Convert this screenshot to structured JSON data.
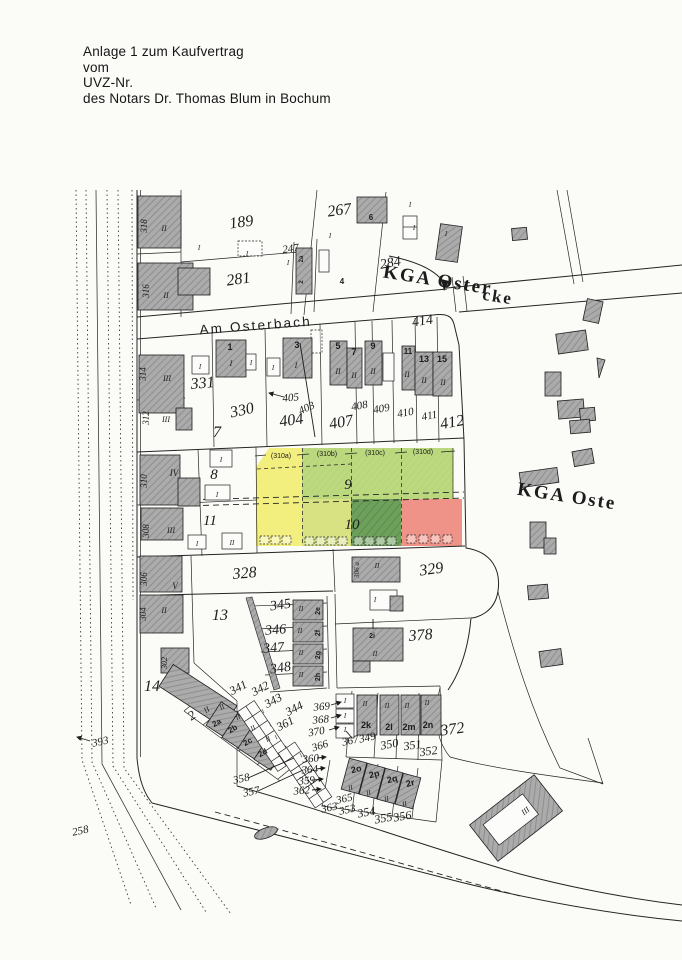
{
  "header": {
    "line1": "Anlage 1 zum Kaufvertrag",
    "line2": "vom",
    "line3": "UVZ-Nr.",
    "line4": "des Notars Dr. Thomas Blum in Bochum"
  },
  "map": {
    "street_label": "Am Osterbach",
    "kga_top_label": "KGA Oster",
    "kga_top_label_cont": "cke",
    "kga_right_label": "KGA Oste",
    "highlight_colors": {
      "yellow": "#f1ee69",
      "light_green": "#b2d46a",
      "yellow_green": "#d3de6e",
      "dark_green": "#55913f",
      "red": "#ee8175"
    },
    "labels": [
      {
        "t": "318",
        "x": 147,
        "y": 226,
        "r": -90,
        "s": 9,
        "c": "vert"
      },
      {
        "t": "II",
        "x": 164,
        "y": 231,
        "s": 8,
        "c": "roman"
      },
      {
        "t": "316",
        "x": 149,
        "y": 291,
        "r": -90,
        "s": 9,
        "c": "vert"
      },
      {
        "t": "II",
        "x": 166,
        "y": 298,
        "s": 8,
        "c": "roman"
      },
      {
        "t": "189",
        "x": 242,
        "y": 227,
        "r": -8,
        "s": 16
      },
      {
        "t": "267",
        "x": 340,
        "y": 215,
        "r": -8,
        "s": 16
      },
      {
        "t": "247",
        "x": 291,
        "y": 252,
        "r": -8,
        "s": 11
      },
      {
        "t": "281",
        "x": 239,
        "y": 284,
        "r": -8,
        "s": 16
      },
      {
        "t": "284",
        "x": 391,
        "y": 267,
        "r": -10,
        "s": 14
      },
      {
        "t": "414",
        "x": 423,
        "y": 325,
        "r": -8,
        "s": 14
      },
      {
        "t": "6",
        "x": 371,
        "y": 220,
        "s": 8,
        "c": "house"
      },
      {
        "t": "4",
        "x": 342,
        "y": 284,
        "s": 8,
        "c": "house"
      },
      {
        "t": "2a",
        "x": 303,
        "y": 259,
        "r": -90,
        "s": 6,
        "c": "house"
      },
      {
        "t": "2",
        "x": 303,
        "y": 282,
        "r": -90,
        "s": 6,
        "c": "house"
      },
      {
        "t": "I",
        "x": 199,
        "y": 250,
        "s": 7,
        "c": "roman"
      },
      {
        "t": "I",
        "x": 247,
        "y": 256,
        "s": 7,
        "c": "roman"
      },
      {
        "t": "I",
        "x": 288,
        "y": 265,
        "s": 7,
        "c": "roman"
      },
      {
        "t": "I",
        "x": 330,
        "y": 238,
        "s": 7,
        "c": "roman"
      },
      {
        "t": "I",
        "x": 410,
        "y": 207,
        "s": 7,
        "c": "roman"
      },
      {
        "t": "I",
        "x": 414,
        "y": 230,
        "s": 7,
        "c": "roman"
      },
      {
        "t": "I",
        "x": 446,
        "y": 236,
        "s": 7,
        "c": "roman"
      },
      {
        "t": "1",
        "x": 230,
        "y": 350,
        "s": 9,
        "c": "house"
      },
      {
        "t": "3",
        "x": 297,
        "y": 348,
        "s": 9,
        "c": "house"
      },
      {
        "t": "5",
        "x": 338,
        "y": 349,
        "s": 9,
        "c": "house"
      },
      {
        "t": "7",
        "x": 354,
        "y": 355,
        "s": 9,
        "c": "house"
      },
      {
        "t": "9",
        "x": 373,
        "y": 349,
        "s": 9,
        "c": "house"
      },
      {
        "t": "11",
        "x": 408,
        "y": 354,
        "s": 8,
        "c": "house"
      },
      {
        "t": "13",
        "x": 424,
        "y": 362,
        "s": 9,
        "c": "house"
      },
      {
        "t": "15",
        "x": 442,
        "y": 362,
        "s": 9,
        "c": "house"
      },
      {
        "t": "I",
        "x": 231,
        "y": 366,
        "s": 8,
        "c": "roman"
      },
      {
        "t": "I",
        "x": 296,
        "y": 368,
        "s": 8,
        "c": "roman"
      },
      {
        "t": "II",
        "x": 338,
        "y": 374,
        "s": 8,
        "c": "roman"
      },
      {
        "t": "II",
        "x": 354,
        "y": 378,
        "s": 8,
        "c": "roman"
      },
      {
        "t": "II",
        "x": 373,
        "y": 374,
        "s": 8,
        "c": "roman"
      },
      {
        "t": "II",
        "x": 407,
        "y": 377,
        "s": 8,
        "c": "roman"
      },
      {
        "t": "II",
        "x": 424,
        "y": 383,
        "s": 8,
        "c": "roman"
      },
      {
        "t": "II",
        "x": 443,
        "y": 385,
        "s": 8,
        "c": "roman"
      },
      {
        "t": "I",
        "x": 200,
        "y": 369,
        "s": 7,
        "c": "roman"
      },
      {
        "t": "I",
        "x": 251,
        "y": 365,
        "s": 7,
        "c": "roman"
      },
      {
        "t": "I",
        "x": 273,
        "y": 370,
        "s": 7,
        "c": "roman"
      },
      {
        "t": "314",
        "x": 146,
        "y": 374,
        "r": -90,
        "s": 9,
        "c": "vert"
      },
      {
        "t": "III",
        "x": 167,
        "y": 381,
        "s": 8,
        "c": "roman"
      },
      {
        "t": "312",
        "x": 149,
        "y": 418,
        "r": -90,
        "s": 9,
        "c": "vert"
      },
      {
        "t": "III",
        "x": 166,
        "y": 422,
        "s": 8,
        "c": "roman"
      },
      {
        "t": "331",
        "x": 203,
        "y": 388,
        "r": -5,
        "s": 16
      },
      {
        "t": "330",
        "x": 243,
        "y": 415,
        "r": -12,
        "s": 16
      },
      {
        "t": "7",
        "x": 217,
        "y": 437,
        "s": 16
      },
      {
        "t": "404",
        "x": 292,
        "y": 425,
        "r": -8,
        "s": 16
      },
      {
        "t": "405",
        "x": 291,
        "y": 401,
        "r": -5,
        "s": 11
      },
      {
        "t": "403",
        "x": 308,
        "y": 411,
        "r": -25,
        "s": 11
      },
      {
        "t": "407",
        "x": 342,
        "y": 427,
        "r": -10,
        "s": 16
      },
      {
        "t": "408",
        "x": 360,
        "y": 409,
        "r": -10,
        "s": 11
      },
      {
        "t": "409",
        "x": 382,
        "y": 412,
        "r": -10,
        "s": 11
      },
      {
        "t": "410",
        "x": 406,
        "y": 416,
        "r": -10,
        "s": 11
      },
      {
        "t": "411",
        "x": 430,
        "y": 419,
        "r": -10,
        "s": 11
      },
      {
        "t": "412",
        "x": 453,
        "y": 427,
        "r": -10,
        "s": 16
      },
      {
        "t": "310",
        "x": 147,
        "y": 481,
        "r": -90,
        "s": 9,
        "c": "vert"
      },
      {
        "t": "IV",
        "x": 174,
        "y": 476,
        "s": 9,
        "c": "roman"
      },
      {
        "t": "8",
        "x": 214,
        "y": 479,
        "s": 15
      },
      {
        "t": "I",
        "x": 221,
        "y": 462,
        "s": 7,
        "c": "roman"
      },
      {
        "t": "I",
        "x": 217,
        "y": 497,
        "s": 7,
        "c": "roman"
      },
      {
        "t": "308",
        "x": 149,
        "y": 531,
        "r": -90,
        "s": 9,
        "c": "vert"
      },
      {
        "t": "III",
        "x": 171,
        "y": 533,
        "s": 8,
        "c": "roman"
      },
      {
        "t": "11",
        "x": 210,
        "y": 525,
        "s": 15
      },
      {
        "t": "I",
        "x": 197,
        "y": 546,
        "s": 7,
        "c": "roman"
      },
      {
        "t": "II",
        "x": 232,
        "y": 545,
        "s": 7,
        "c": "roman"
      },
      {
        "t": "306",
        "x": 147,
        "y": 579,
        "r": -90,
        "s": 9,
        "c": "vert"
      },
      {
        "t": "V",
        "x": 175,
        "y": 589,
        "s": 9,
        "c": "roman"
      },
      {
        "t": "(310a)",
        "x": 281,
        "y": 458,
        "s": 7,
        "c": "paren"
      },
      {
        "t": "(310b)",
        "x": 327,
        "y": 456,
        "s": 7,
        "c": "paren"
      },
      {
        "t": "(310c)",
        "x": 375,
        "y": 455,
        "s": 7,
        "c": "paren"
      },
      {
        "t": "(310d)",
        "x": 423,
        "y": 454,
        "s": 7,
        "c": "paren"
      },
      {
        "t": "9",
        "x": 348,
        "y": 489,
        "s": 15
      },
      {
        "t": "10",
        "x": 352,
        "y": 529,
        "s": 15
      },
      {
        "t": "328",
        "x": 245,
        "y": 578,
        "r": -5,
        "s": 16
      },
      {
        "t": "329",
        "x": 432,
        "y": 574,
        "r": -8,
        "s": 16
      },
      {
        "t": "306 a",
        "x": 359,
        "y": 570,
        "r": -90,
        "s": 7,
        "c": "vert"
      },
      {
        "t": "II",
        "x": 377,
        "y": 568,
        "s": 7,
        "c": "roman"
      },
      {
        "t": "I",
        "x": 375,
        "y": 602,
        "s": 7,
        "c": "roman"
      },
      {
        "t": "13",
        "x": 220,
        "y": 620,
        "s": 16
      },
      {
        "t": "345",
        "x": 281,
        "y": 609,
        "r": -8,
        "s": 14
      },
      {
        "t": "346",
        "x": 276,
        "y": 634,
        "r": -5,
        "s": 14
      },
      {
        "t": "347",
        "x": 274,
        "y": 652,
        "r": -5,
        "s": 14
      },
      {
        "t": "348",
        "x": 281,
        "y": 672,
        "r": -8,
        "s": 14
      },
      {
        "t": "2e",
        "x": 320,
        "y": 611,
        "r": -90,
        "s": 7,
        "c": "house"
      },
      {
        "t": "2f",
        "x": 320,
        "y": 633,
        "r": -90,
        "s": 7,
        "c": "house"
      },
      {
        "t": "2g",
        "x": 320,
        "y": 655,
        "r": -90,
        "s": 7,
        "c": "house"
      },
      {
        "t": "2h",
        "x": 320,
        "y": 677,
        "r": -90,
        "s": 7,
        "c": "house"
      },
      {
        "t": "II",
        "x": 301,
        "y": 611,
        "s": 7,
        "c": "roman"
      },
      {
        "t": "II",
        "x": 300,
        "y": 633,
        "s": 7,
        "c": "roman"
      },
      {
        "t": "II",
        "x": 301,
        "y": 655,
        "s": 7,
        "c": "roman"
      },
      {
        "t": "II",
        "x": 301,
        "y": 677,
        "s": 7,
        "c": "roman"
      },
      {
        "t": "378",
        "x": 421,
        "y": 640,
        "r": -5,
        "s": 16
      },
      {
        "t": "2i",
        "x": 372,
        "y": 638,
        "s": 7,
        "c": "house"
      },
      {
        "t": "II",
        "x": 375,
        "y": 656,
        "s": 7,
        "c": "roman"
      },
      {
        "t": "304",
        "x": 146,
        "y": 614,
        "r": -90,
        "s": 9,
        "c": "vert"
      },
      {
        "t": "II",
        "x": 164,
        "y": 613,
        "s": 8,
        "c": "roman"
      },
      {
        "t": "302",
        "x": 167,
        "y": 663,
        "r": -90,
        "s": 8,
        "c": "vert"
      },
      {
        "t": "14",
        "x": 152,
        "y": 691,
        "s": 16
      },
      {
        "t": "2",
        "x": 194,
        "y": 719,
        "r": -33,
        "s": 13
      },
      {
        "t": "II",
        "x": 208,
        "y": 712,
        "r": -33,
        "s": 8,
        "c": "roman"
      },
      {
        "t": "393",
        "x": 101,
        "y": 745,
        "r": -12,
        "s": 11
      },
      {
        "t": "258",
        "x": 81,
        "y": 834,
        "r": -12,
        "s": 11
      },
      {
        "t": "341",
        "x": 240,
        "y": 691,
        "r": -28,
        "s": 12
      },
      {
        "t": "342",
        "x": 262,
        "y": 692,
        "r": -28,
        "s": 12
      },
      {
        "t": "343",
        "x": 275,
        "y": 704,
        "r": -28,
        "s": 12
      },
      {
        "t": "344",
        "x": 296,
        "y": 712,
        "r": -28,
        "s": 12
      },
      {
        "t": "361",
        "x": 287,
        "y": 727,
        "r": -28,
        "s": 12
      },
      {
        "t": "2a",
        "x": 218,
        "y": 725,
        "r": -30,
        "s": 8,
        "c": "house"
      },
      {
        "t": "2b",
        "x": 234,
        "y": 731,
        "r": -30,
        "s": 8,
        "c": "house"
      },
      {
        "t": "2c",
        "x": 249,
        "y": 744,
        "r": -30,
        "s": 8,
        "c": "house"
      },
      {
        "t": "2d",
        "x": 264,
        "y": 755,
        "r": -30,
        "s": 8,
        "c": "house"
      },
      {
        "t": "II",
        "x": 223,
        "y": 709,
        "r": -30,
        "s": 7,
        "c": "roman"
      },
      {
        "t": "II",
        "x": 239,
        "y": 719,
        "r": -30,
        "s": 7,
        "c": "roman"
      },
      {
        "t": "II",
        "x": 254,
        "y": 730,
        "r": -30,
        "s": 7,
        "c": "roman"
      },
      {
        "t": "II",
        "x": 269,
        "y": 741,
        "r": -30,
        "s": 7,
        "c": "roman"
      },
      {
        "t": "369",
        "x": 322,
        "y": 710,
        "r": -5,
        "s": 11
      },
      {
        "t": "368",
        "x": 321,
        "y": 723,
        "r": -5,
        "s": 11
      },
      {
        "t": "370",
        "x": 317,
        "y": 735,
        "r": -10,
        "s": 11
      },
      {
        "t": "366",
        "x": 321,
        "y": 749,
        "r": -18,
        "s": 11
      },
      {
        "t": "367",
        "x": 351,
        "y": 744,
        "r": -12,
        "s": 11
      },
      {
        "t": "349",
        "x": 368,
        "y": 741,
        "r": -12,
        "s": 11
      },
      {
        "t": "350",
        "x": 390,
        "y": 748,
        "r": -10,
        "s": 12
      },
      {
        "t": "351",
        "x": 413,
        "y": 749,
        "r": -8,
        "s": 12
      },
      {
        "t": "352",
        "x": 429,
        "y": 755,
        "r": -8,
        "s": 12
      },
      {
        "t": "372",
        "x": 453,
        "y": 734,
        "r": -8,
        "s": 16
      },
      {
        "t": "I",
        "x": 345,
        "y": 703,
        "s": 7,
        "c": "roman"
      },
      {
        "t": "I",
        "x": 345,
        "y": 718,
        "s": 7,
        "c": "roman"
      },
      {
        "t": "I",
        "x": 345,
        "y": 732,
        "s": 7,
        "c": "roman"
      },
      {
        "t": "2k",
        "x": 366,
        "y": 728,
        "s": 9,
        "c": "house"
      },
      {
        "t": "2l",
        "x": 389,
        "y": 730,
        "s": 9,
        "c": "house"
      },
      {
        "t": "2m",
        "x": 409,
        "y": 730,
        "s": 9,
        "c": "house"
      },
      {
        "t": "2n",
        "x": 428,
        "y": 728,
        "s": 9,
        "c": "house"
      },
      {
        "t": "II",
        "x": 365,
        "y": 706,
        "s": 7,
        "c": "roman"
      },
      {
        "t": "II",
        "x": 387,
        "y": 708,
        "s": 7,
        "c": "roman"
      },
      {
        "t": "II",
        "x": 407,
        "y": 708,
        "s": 7,
        "c": "roman"
      },
      {
        "t": "II",
        "x": 427,
        "y": 705,
        "s": 7,
        "c": "roman"
      },
      {
        "t": "360",
        "x": 311,
        "y": 762,
        "r": -5,
        "s": 11
      },
      {
        "t": "364",
        "x": 310,
        "y": 773,
        "r": -5,
        "s": 11
      },
      {
        "t": "359",
        "x": 307,
        "y": 784,
        "r": -5,
        "s": 11
      },
      {
        "t": "362",
        "x": 302,
        "y": 794,
        "r": -5,
        "s": 11
      },
      {
        "t": "358",
        "x": 242,
        "y": 782,
        "r": -12,
        "s": 11
      },
      {
        "t": "357",
        "x": 252,
        "y": 795,
        "r": -12,
        "s": 11
      },
      {
        "t": "365",
        "x": 345,
        "y": 802,
        "r": -12,
        "s": 11
      },
      {
        "t": "363",
        "x": 330,
        "y": 811,
        "r": -12,
        "s": 11
      },
      {
        "t": "353",
        "x": 348,
        "y": 813,
        "r": -12,
        "s": 11
      },
      {
        "t": "354",
        "x": 367,
        "y": 816,
        "r": -10,
        "s": 12
      },
      {
        "t": "355",
        "x": 384,
        "y": 822,
        "r": -10,
        "s": 12
      },
      {
        "t": "356",
        "x": 403,
        "y": 820,
        "r": -10,
        "s": 12
      },
      {
        "t": "2o",
        "x": 357,
        "y": 772,
        "r": -15,
        "s": 9,
        "c": "house"
      },
      {
        "t": "2p",
        "x": 375,
        "y": 777,
        "r": -15,
        "s": 9,
        "c": "house"
      },
      {
        "t": "2q",
        "x": 393,
        "y": 782,
        "r": -15,
        "s": 9,
        "c": "house"
      },
      {
        "t": "2r",
        "x": 411,
        "y": 786,
        "r": -15,
        "s": 9,
        "c": "house"
      },
      {
        "t": "II",
        "x": 351,
        "y": 790,
        "r": -15,
        "s": 7,
        "c": "roman"
      },
      {
        "t": "II",
        "x": 369,
        "y": 795,
        "r": -15,
        "s": 7,
        "c": "roman"
      },
      {
        "t": "II",
        "x": 387,
        "y": 801,
        "r": -15,
        "s": 7,
        "c": "roman"
      },
      {
        "t": "II",
        "x": 405,
        "y": 806,
        "r": -15,
        "s": 7,
        "c": "roman"
      },
      {
        "t": "III",
        "x": 527,
        "y": 813,
        "r": -38,
        "s": 8,
        "c": "roman"
      },
      {
        "t": "I",
        "x": 264,
        "y": 713,
        "r": -32,
        "s": 6,
        "c": "roman"
      },
      {
        "t": "I",
        "x": 271,
        "y": 726,
        "r": -32,
        "s": 6,
        "c": "roman"
      },
      {
        "t": "I",
        "x": 277,
        "y": 739,
        "r": -32,
        "s": 6,
        "c": "roman"
      },
      {
        "t": "I",
        "x": 302,
        "y": 757,
        "r": -32,
        "s": 6,
        "c": "roman"
      },
      {
        "t": "I",
        "x": 308,
        "y": 770,
        "r": -32,
        "s": 6,
        "c": "roman"
      },
      {
        "t": "I",
        "x": 314,
        "y": 783,
        "r": -32,
        "s": 6,
        "c": "roman"
      }
    ]
  }
}
